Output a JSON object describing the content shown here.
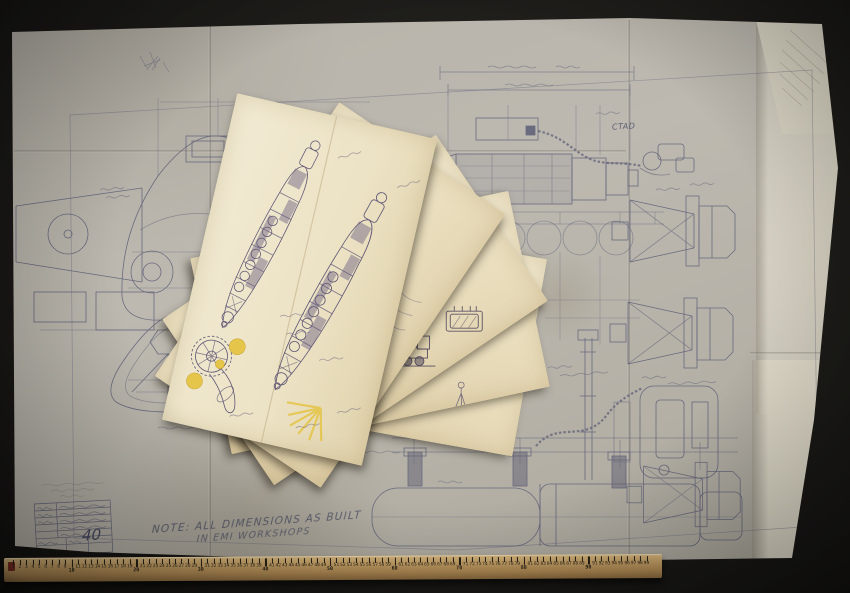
{
  "scene": {
    "background_color": "#1b1a17"
  },
  "blueprint": {
    "paper_color": "#bab6ad",
    "ink_color": "#565873",
    "handwritten_note": {
      "line1": "NOTE: ALL DIMENSIONS AS BUILT",
      "line2": "IN EMI WORKSHOPS"
    },
    "annotations": {
      "ctad": "CTAD"
    },
    "title_block": {
      "drawing_number": "40"
    }
  },
  "sketch_sheets": {
    "count": 5,
    "paper_color": "#ece2c4",
    "pencil_color": "#5d5574",
    "highlight_color": "#e5c33c"
  },
  "ruler": {
    "first_number": 1,
    "last_number": 99,
    "major_interval": 10,
    "wood_color": "#c6a267",
    "marking_color": "#241f16"
  }
}
